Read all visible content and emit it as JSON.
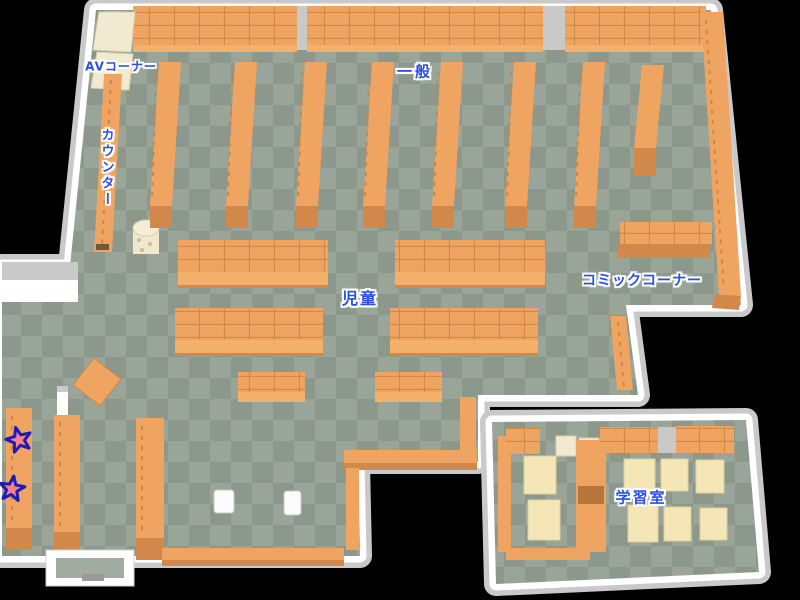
{
  "map": {
    "type": "library-floor-map",
    "labels": {
      "av_corner": "AVコーナー",
      "counter": "カウンター",
      "general": "一般",
      "children": "児童",
      "comic_corner": "コミックコーナー",
      "study_room": "学習室"
    },
    "markers": {
      "stars": [
        {
          "x": 19,
          "y": 440
        },
        {
          "x": 12,
          "y": 489
        }
      ]
    },
    "colors": {
      "background": "#000000",
      "floor_light": "#98a598",
      "floor_dark": "#8b988b",
      "wall": "#ffffff",
      "wall_top": "#c9c9c9",
      "shelf": "#efa462",
      "shelf_front": "#d2884a",
      "shelf_light": "#f3b06a",
      "shelf_line": "#c9823f",
      "cabinet_cream": "#f1ead0",
      "desk_cream": "#f5e6b8",
      "label_blue": "#2a4fe8",
      "star_fill": "#f8808e",
      "star_outline": "#1c1cb8"
    }
  }
}
